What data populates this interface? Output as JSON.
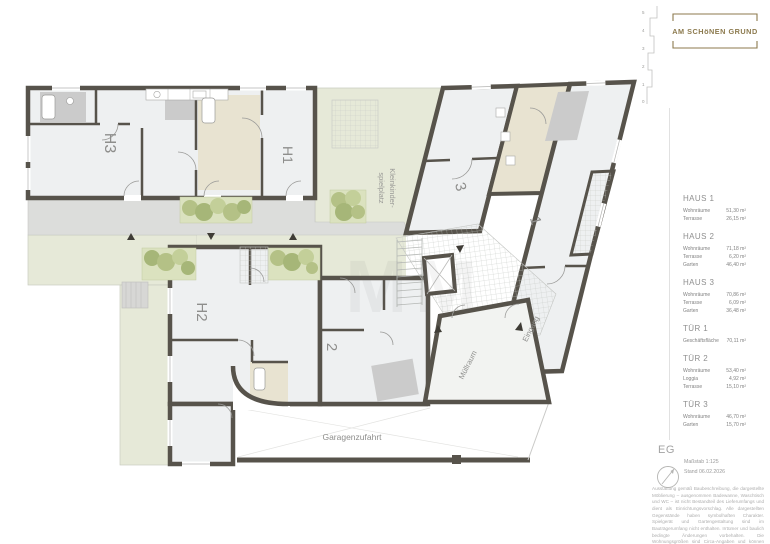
{
  "logo": {
    "text": "AM SCHöNEN GRUND",
    "color": "#8c7a4e"
  },
  "story_ruler": {
    "values": [
      "5",
      "4",
      "3",
      "2",
      "1",
      "0"
    ]
  },
  "legend": {
    "blocks": [
      {
        "title": "HAUS 1",
        "rows": [
          [
            "Wohnräume",
            "51,30 m²"
          ],
          [
            "Terrasse",
            "26,15 m²"
          ]
        ]
      },
      {
        "title": "HAUS 2",
        "rows": [
          [
            "Wohnräume",
            "71,18 m²"
          ],
          [
            "Terrasse",
            "6,20 m²"
          ],
          [
            "Garten",
            "46,40 m²"
          ]
        ]
      },
      {
        "title": "HAUS 3",
        "rows": [
          [
            "Wohnräume",
            "70,86 m²"
          ],
          [
            "Terrasse",
            "6,09 m²"
          ],
          [
            "Garten",
            "36,48 m²"
          ]
        ]
      },
      {
        "title": "TÜR 1",
        "rows": [
          [
            "Geschäftsfläche",
            "70,11 m²"
          ]
        ]
      },
      {
        "title": "TÜR 2",
        "rows": [
          [
            "Wohnräume",
            "53,40 m²"
          ],
          [
            "Loggia",
            "4,92 m²"
          ],
          [
            "Terrasse",
            "15,10 m²"
          ]
        ]
      },
      {
        "title": "TÜR 3",
        "rows": [
          [
            "Wohnräume",
            "46,70 m²"
          ],
          [
            "Garten",
            "15,70 m²"
          ]
        ]
      }
    ]
  },
  "footer": {
    "level": "EG",
    "scale": "Maßstab 1:125",
    "date": "Stand 06.02.2026",
    "disclaimer": "Ausstattung gemäß Baubeschreibung, die dargestellte Möblierung – ausgenommen Badewanne, Waschtisch und WC – ist nicht Bestandteil des Lieferumfangs und dient als Einrichtungsvorschlag. Alle dargestellten Gegenstände haben symbolhaften Charakter. Spielgerät und Gartengestaltung sind im Bauträgerumfang nicht enthalten. Irrtümer und baulich bedingte Änderungen vorbehalten. Die Wohnungsgrößen sind Circa-Angaben und können sich durch die Detailplanung geringfügig ändern. Maßgeblich ist in jedem Fall der Kaufvertrag."
  },
  "plan": {
    "watermark": "MM",
    "labels": {
      "h1": "H1",
      "h2": "H2",
      "h3": "H3",
      "u1": "1",
      "u2": "2",
      "u3": "3",
      "playground1": "Kleinkinder-",
      "playground2": "spielplatz",
      "garage": "Garagenzufahrt",
      "muell": "Müllraum",
      "eingang": "Eingang"
    },
    "colors": {
      "wall": "#57534b",
      "floor": "#eef0f1",
      "outdoor": "#e6e9d8",
      "plant": "#b4c186",
      "beige": "#e8e3d1",
      "bath": "#cbcbcb",
      "corridor": "#dcdddb",
      "accent_gold": "#8c7a4e"
    }
  }
}
